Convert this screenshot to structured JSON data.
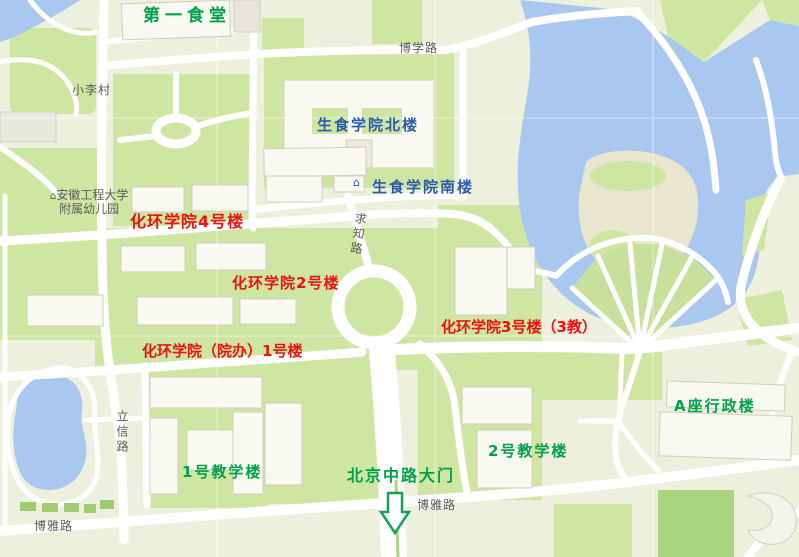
{
  "map": {
    "building_labels": [
      {
        "id": "canteen-1",
        "text": "第一食堂",
        "color": "#00a14b"
      },
      {
        "id": "shengshi-north",
        "text": "生食学院北楼",
        "color": "#2b5cab"
      },
      {
        "id": "shengshi-south",
        "text": "生食学院南楼",
        "color": "#2b5cab"
      },
      {
        "id": "huahuan-4",
        "text": "化环学院4号楼",
        "color": "#ee1111"
      },
      {
        "id": "huahuan-2",
        "text": "化环学院2号楼",
        "color": "#ee1111"
      },
      {
        "id": "huahuan-3",
        "text": "化环学院3号楼（3教）",
        "color": "#ee1111"
      },
      {
        "id": "huahuan-1",
        "text": "化环学院（院办）1号楼",
        "color": "#ee1111"
      },
      {
        "id": "admin-a",
        "text": "A座行政楼",
        "color": "#00a14b"
      },
      {
        "id": "teaching-2",
        "text": "2号教学楼",
        "color": "#00a14b"
      },
      {
        "id": "teaching-1",
        "text": "1号教学楼",
        "color": "#00a14b"
      },
      {
        "id": "gate-beijing-rd",
        "text": "北京中路大门",
        "color": "#00a14b"
      }
    ],
    "road_labels": [
      {
        "id": "boxue-road",
        "text": "博学路"
      },
      {
        "id": "qiuzhi-road",
        "text": "求知路",
        "orientation": "vertical"
      },
      {
        "id": "lixin-road",
        "text": "立信路",
        "orientation": "vertical"
      },
      {
        "id": "boya-road-west",
        "text": "博雅路"
      },
      {
        "id": "boya-road-center",
        "text": "博雅路"
      },
      {
        "id": "xiaoli-village",
        "text": "小李村"
      }
    ],
    "poi_labels": [
      {
        "id": "kindergarten",
        "line1": "安徽工程大学",
        "line2": "附属幼儿园"
      }
    ],
    "icons": [
      {
        "id": "south-building-icon",
        "glyph": "⌂"
      },
      {
        "id": "kindergarten-icon",
        "glyph": "⌂"
      },
      {
        "id": "gate-arrow-icon",
        "glyph": "↓"
      }
    ],
    "colors": {
      "green_label": "#00a14b",
      "red_label": "#ee1111",
      "blue_label": "#2b5cab",
      "road_label": "#5e5c58",
      "water": "#a9c7ef",
      "green_area": "#cfe6a3",
      "dark_field": "#abd47e",
      "road": "#ffffff",
      "building": "#f9f8f1",
      "base": "#eef0de"
    }
  }
}
